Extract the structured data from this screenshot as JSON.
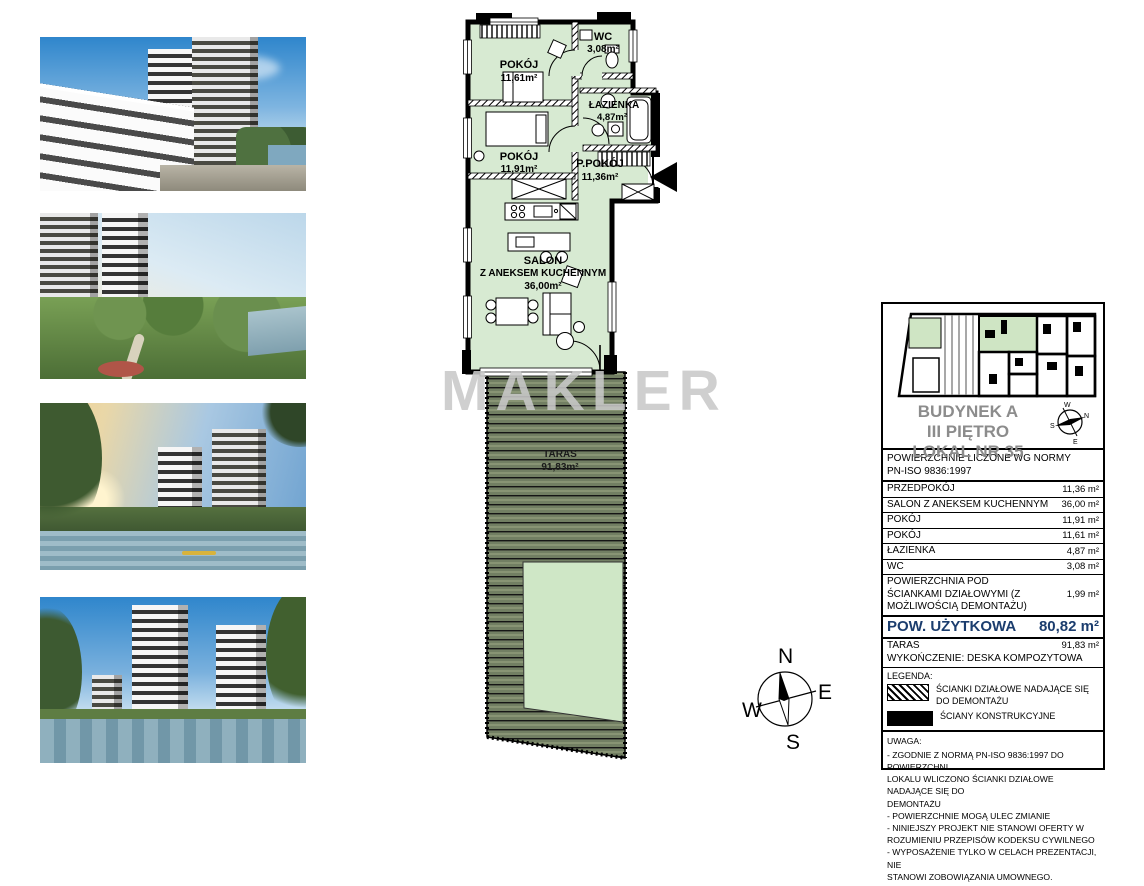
{
  "watermark": "MAKLER",
  "plan": {
    "rooms": {
      "pokoj1": {
        "name": "POKÓJ",
        "area": "11,61m²"
      },
      "wc": {
        "name": "WC",
        "area": "3,08m²"
      },
      "lazienka": {
        "name": "ŁAZIENKA",
        "area": "4,87m²"
      },
      "pokoj2": {
        "name": "POKÓJ",
        "area": "11,91m²"
      },
      "ppokoj": {
        "name": "P.POKÓJ",
        "area": "11,36m²"
      },
      "salon": {
        "name": "SALON",
        "name2": "Z ANEKSEM KUCHENNYM",
        "area": "36,00m²"
      },
      "taras": {
        "name": "TARAS",
        "area": "91,83m²"
      }
    }
  },
  "compass": {
    "north": "N",
    "east": "E",
    "south": "S",
    "west": "W"
  },
  "info_panel": {
    "title_line1": "BUDYNEK A",
    "title_line2": "III PIĘTRO",
    "title_line3": "LOKAL NR 35",
    "norm_line1": "POWIERZCHNIE LICZONE WG NORMY",
    "norm_line2": "PN-ISO 9836:1997",
    "rows": [
      {
        "label": "PRZEDPOKÓJ",
        "value": "11,36 m²"
      },
      {
        "label": "SALON Z ANEKSEM KUCHENNYM",
        "value": "36,00 m²"
      },
      {
        "label": "POKÓJ",
        "value": "11,91 m²"
      },
      {
        "label": "POKÓJ",
        "value": "11,61 m²"
      },
      {
        "label": "ŁAZIENKA",
        "value": "4,87 m²"
      },
      {
        "label": "WC",
        "value": "3,08 m²"
      },
      {
        "label": "POWIERZCHNIA POD ŚCIANKAMI DZIAŁOWYMI (Z MOŻLIWOŚCIĄ DEMONTAŻU)",
        "value": "1,99 m²"
      }
    ],
    "total": {
      "label": "POW. UŻYTKOWA",
      "value": "80,82 m²"
    },
    "taras_row": {
      "label": "TARAS",
      "value": "91,83 m²"
    },
    "finish_line": "WYKOŃCZENIE: DESKA KOMPOZYTOWA",
    "legend": {
      "title": "LEGENDA:",
      "item1": "ŚCIANKI DZIAŁOWE NADAJĄCE SIĘ\nDO DEMONTAŻU",
      "item2": "ŚCIANY KONSTRUKCYJNE"
    },
    "uwaga": {
      "title": "UWAGA:",
      "text": "- ZGODNIE Z NORMĄ PN-ISO 9836:1997 DO POWIERZCHNI\nLOKALU WLICZONO ŚCIANKI DZIAŁOWE NADAJĄCE SIĘ DO\nDEMONTAŻU\n- POWIERZCHNIE MOGĄ ULEC ZMIANIE\n- NINIEJSZY PROJEKT NIE STANOWI OFERTY W\nROZUMIENIU PRZEPISÓW KODEKSU CYWILNEGO\n- WYPOSAŻENIE TYLKO W CELACH PREZENTACJI, NIE\nSTANOWI ZOBOWIĄZANIA UMOWNEGO."
    }
  },
  "colors": {
    "room_green": "#d7ead2",
    "deck_green": "#727f63",
    "planter_green": "#cfe7c6",
    "total_navy": "#1b3d6e",
    "title_gray": "#8c8c8c",
    "watermark_gray": "#c9c9c9"
  }
}
